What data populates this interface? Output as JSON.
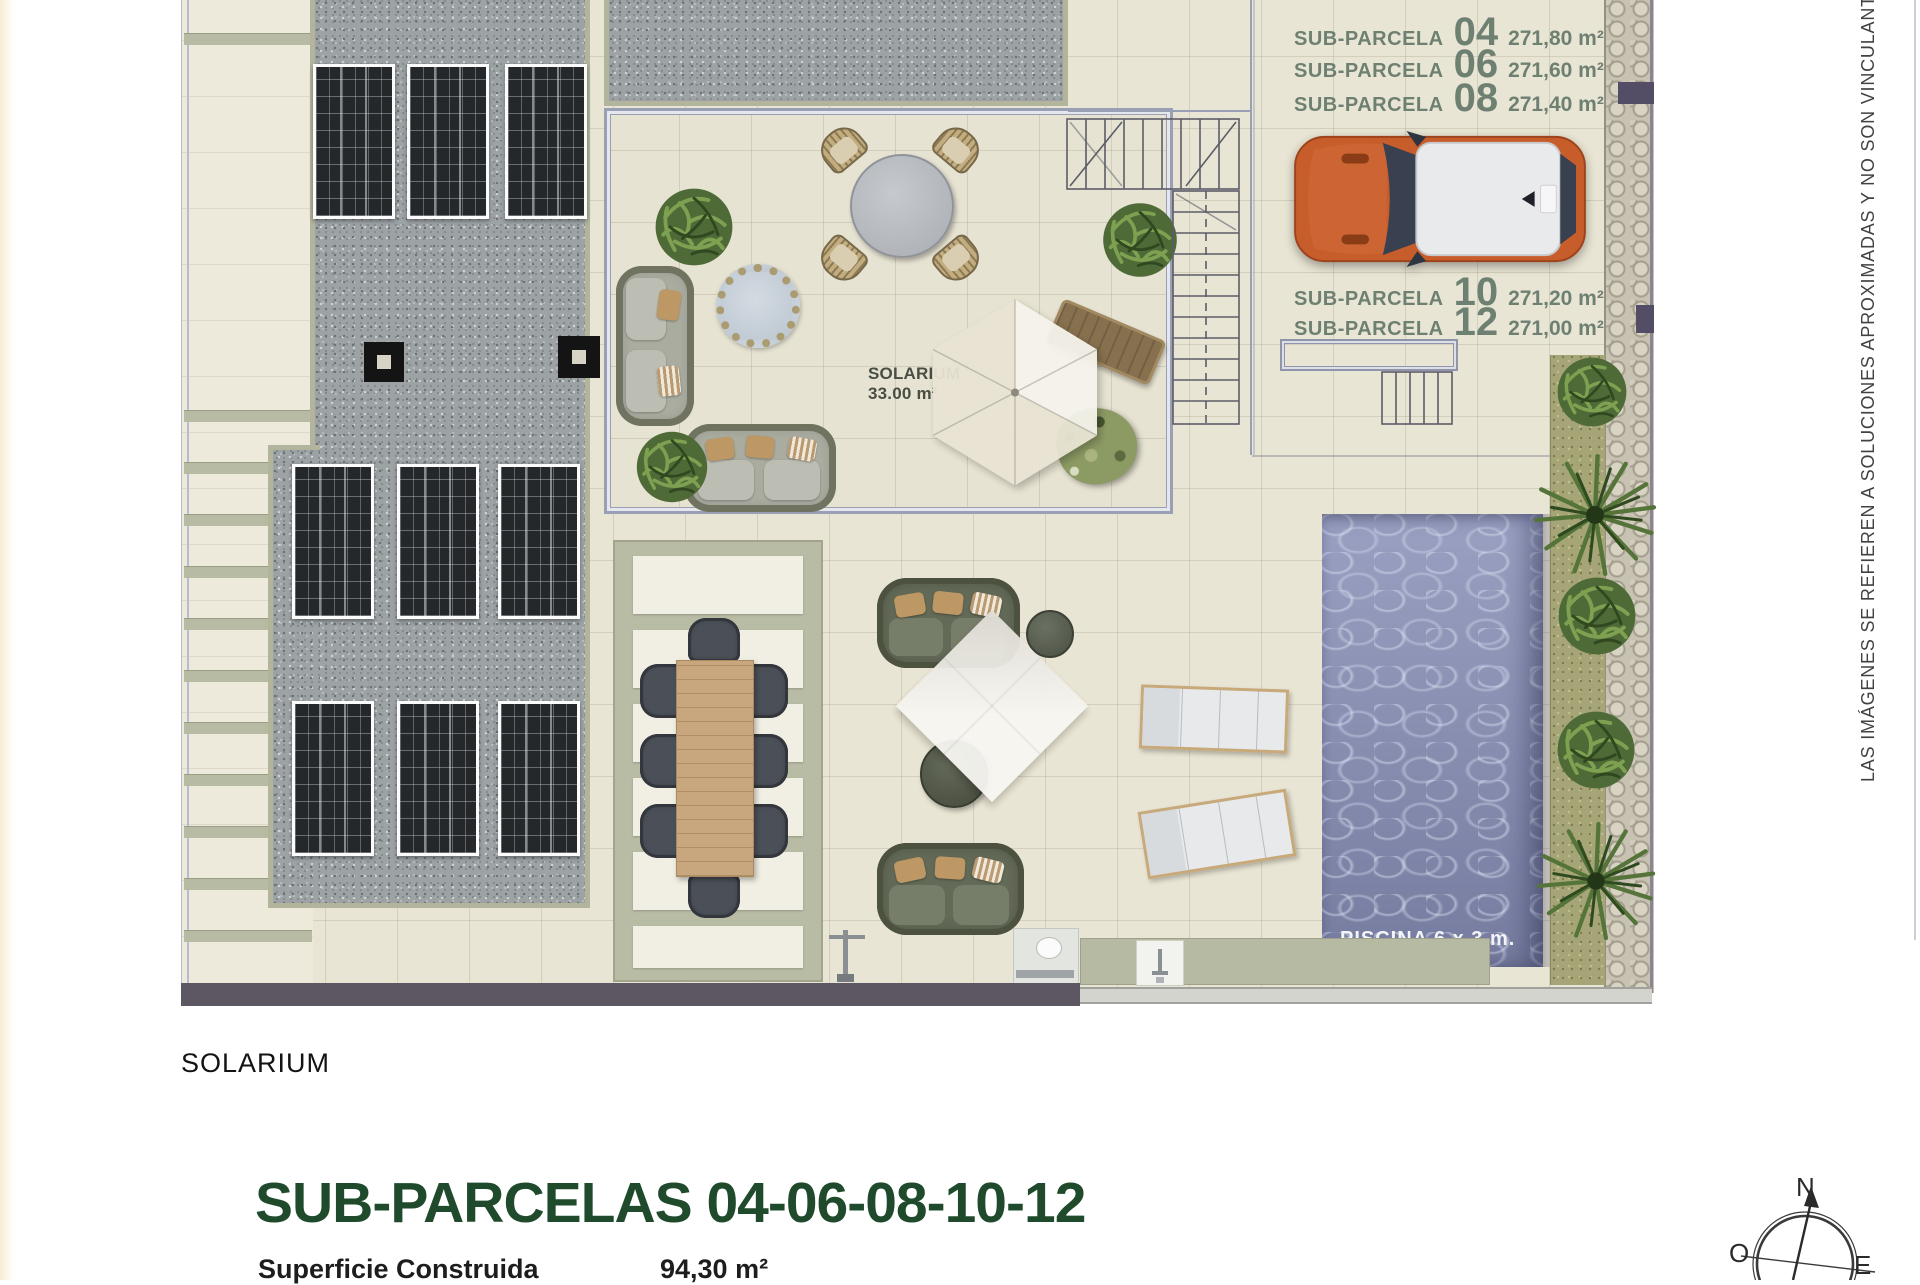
{
  "plan": {
    "parcel_rows_top": [
      {
        "label": "SUB-PARCELA",
        "number": "04",
        "area": "271,80 m²"
      },
      {
        "label": "SUB-PARCELA",
        "number": "06",
        "area": "271,60 m²"
      },
      {
        "label": "SUB-PARCELA",
        "number": "08",
        "area": "271,40 m²"
      }
    ],
    "parcel_rows_mid": [
      {
        "label": "SUB-PARCELA",
        "number": "10",
        "area": "271,20 m²"
      },
      {
        "label": "SUB-PARCELA",
        "number": "12",
        "area": "271,00 m²"
      }
    ],
    "solarium_area_label": {
      "line1": "SOLARIUM",
      "line2": "33.00 m²"
    },
    "pool_label": "PISCINA 6 x 3 m.",
    "floor_label": "SOLARIUM"
  },
  "footer": {
    "title": "SUB-PARCELAS 04-06-08-10-12",
    "surface_label": "Superficie Construida",
    "surface_value": "94,30 m²"
  },
  "compass": {
    "north": "N",
    "west": "O",
    "east": "E"
  },
  "disclaimer": "LAS IMÁGENES SE REFIEREN A SOLUCIONES APROXIMADAS Y NO SON VINCULANTES AL PROYECTO",
  "colors": {
    "title_green": "#1f4b2c",
    "parcel_label_green": "#6e8072",
    "pool_water": "#8b91b5",
    "car_orange": "#c75d2b",
    "gravel_gray": "#9da3a5",
    "sage_green": "#b2b59b"
  }
}
